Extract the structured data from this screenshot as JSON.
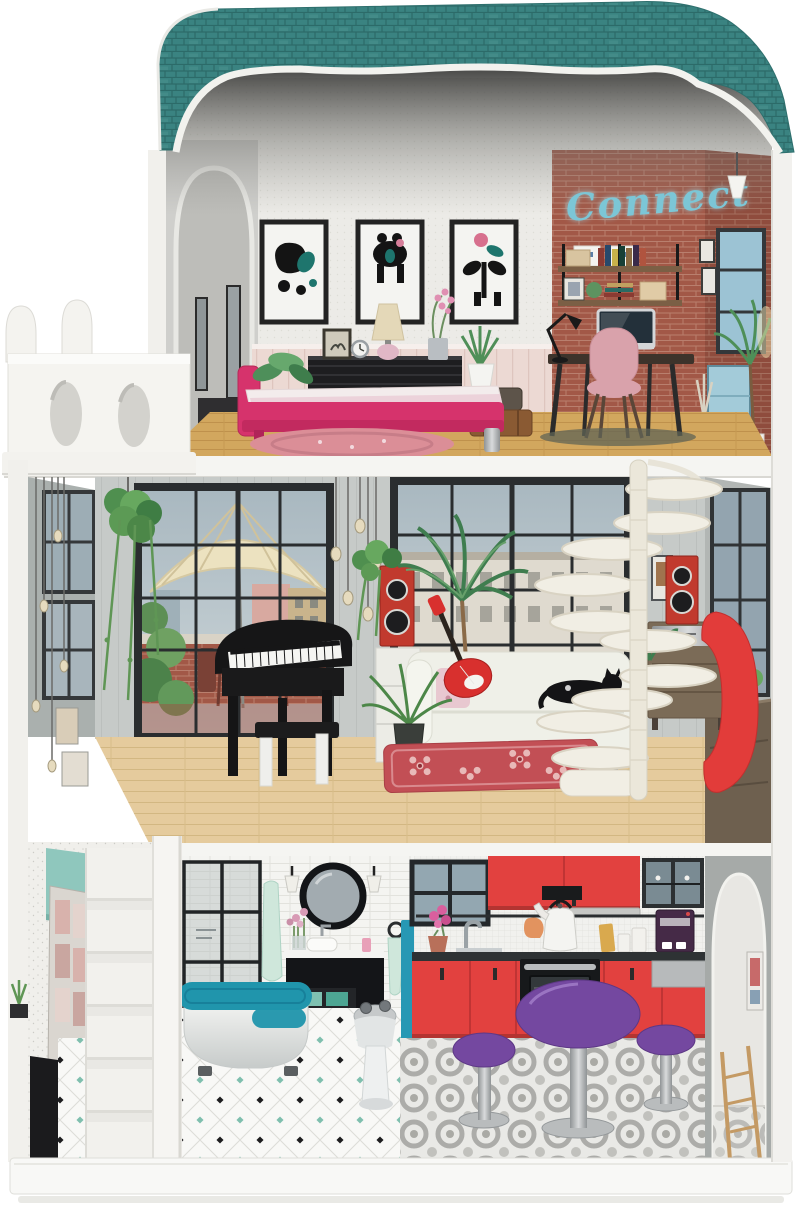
{
  "scene": {
    "type": "product-photo",
    "subject": "three-story wooden dollhouse with balcony, spiral staircase and full furniture set",
    "background": "#ffffff"
  },
  "neon_sign": {
    "text": "Connect",
    "color": "#7cc6d6"
  },
  "palette": {
    "roof_teal": "#3a8381",
    "exterior_white": "#f2f1ed",
    "brick_red": "#a25847",
    "bed_pink": "#d6336c",
    "wainscot_pink": "#ecd9d3",
    "floor_top_wood": "#d2a75e",
    "floor_middle_wood": "#e5cb9d",
    "kitchen_red": "#e2413f",
    "dining_purple": "#7448a0",
    "bathtub_teal": "#2095ac",
    "accent_mint": "#8fc7bd",
    "speaker_red": "#c13a2e",
    "rug_pink": "#db8e97",
    "rug_red": "#c24f55"
  },
  "floors": [
    {
      "level": "top",
      "rooms": [
        {
          "name": "bedroom",
          "items": [
            "wall-art-triptych",
            "double-bed",
            "dresser",
            "table-lamp",
            "alarm-clock",
            "photo-frame",
            "orchid",
            "potted-plant",
            "suitcases",
            "round-rug"
          ]
        },
        {
          "name": "home-office",
          "items": [
            "neon-sign",
            "wall-shelf",
            "storage-boxes",
            "books",
            "desk",
            "computer",
            "desk-lamp",
            "chair",
            "pendant-lamp",
            "window",
            "door",
            "plants",
            "rug"
          ]
        }
      ],
      "exterior": [
        "teal-shingle-roof",
        "white-balcony"
      ]
    },
    {
      "level": "middle",
      "rooms": [
        {
          "name": "living-room",
          "items": [
            "terrace-window-with-umbrella",
            "city-window",
            "pendant-bulbs",
            "hanging-plant",
            "grand-piano",
            "piano-bench",
            "sofa",
            "electric-guitar",
            "cat",
            "palm-plant",
            "fern-plant",
            "speakers",
            "shelf-unit",
            "stereo-cabinet",
            "egg-chair",
            "sideboard",
            "spiral-staircase",
            "floral-rug"
          ]
        }
      ]
    },
    {
      "level": "ground",
      "rooms": [
        {
          "name": "bathroom",
          "items": [
            "shower-screen",
            "round-mirror",
            "wall-sconces",
            "vanity-with-sink",
            "flowers",
            "towels",
            "teal-bathtub",
            "bidet",
            "diamond-tile-floor"
          ]
        },
        {
          "name": "kitchen",
          "items": [
            "upper-cabinets",
            "range-hood",
            "glass-cabinet",
            "tile-backsplash",
            "kettle",
            "coffee-machine",
            "sink",
            "oven",
            "lower-cabinets",
            "purple-dining-table",
            "purple-stools",
            "patterned-tile-floor",
            "arched-doorway",
            "ladder-shelf"
          ]
        }
      ],
      "exterior": [
        "side-staircase",
        "support-column",
        "poster-wall",
        "base-platform"
      ]
    }
  ]
}
